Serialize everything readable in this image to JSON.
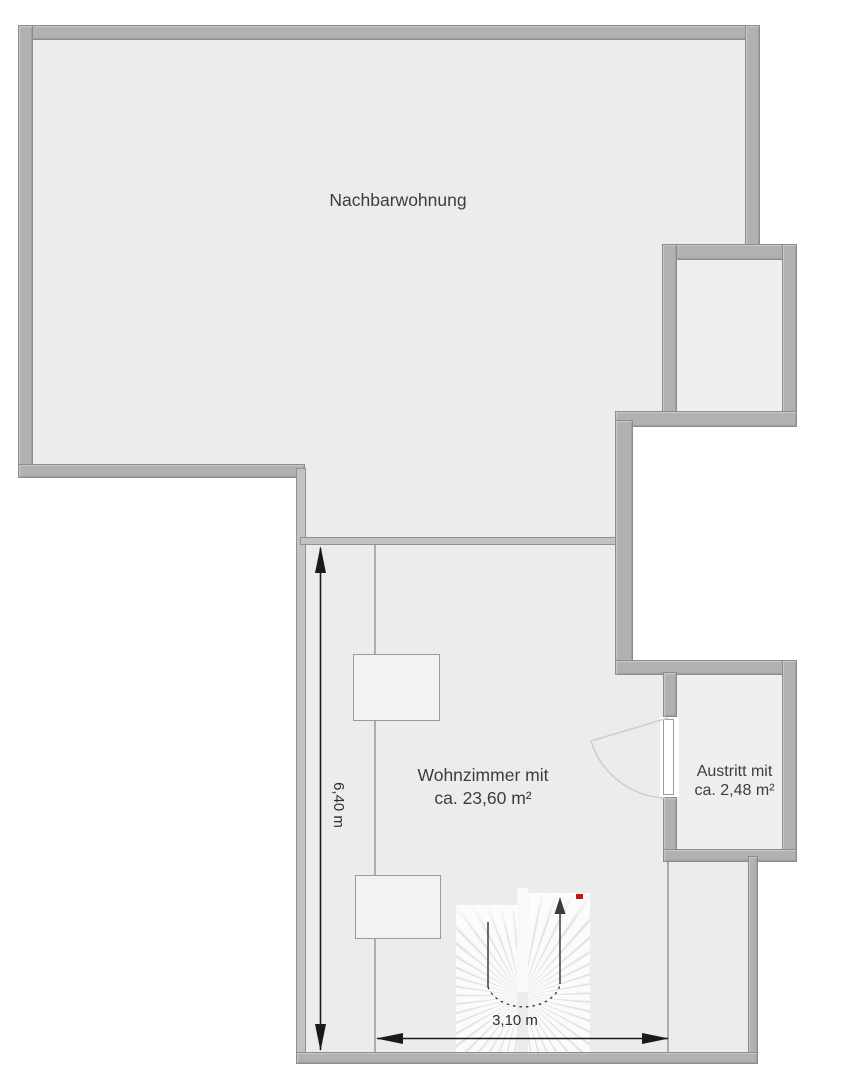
{
  "plan": {
    "rooms": {
      "nachbarwohnung": {
        "label": "Nachbarwohnung"
      },
      "wohnzimmer": {
        "label_line1": "Wohnzimmer mit",
        "label_line2": "ca. 23,60 m²"
      },
      "austritt": {
        "label_line1": "Austritt mit",
        "label_line2": "ca. 2,48 m²"
      }
    },
    "dimensions": {
      "vertical": {
        "label": "6,40 m"
      },
      "horizontal": {
        "label": "3,10 m"
      }
    },
    "icons": {
      "stair_direction": "up-arrow",
      "stair_marker": "red-marker",
      "door_swing": "quarter-arc",
      "dimension_arrows": "double-headed-arrow"
    },
    "colors": {
      "background": "#ffffff",
      "floor": "#ececec",
      "floor_small_rooms": "#efefef",
      "wall_fill": "#b1b1b1",
      "wall_outline": "#8c8c8c",
      "wall_highlight": "#cbcbcb",
      "text": "#3d3d3d",
      "dimension_lines": "#1a1a1a",
      "door_arc": "#cdcdcd",
      "stair_marker_red": "#c41414"
    }
  }
}
